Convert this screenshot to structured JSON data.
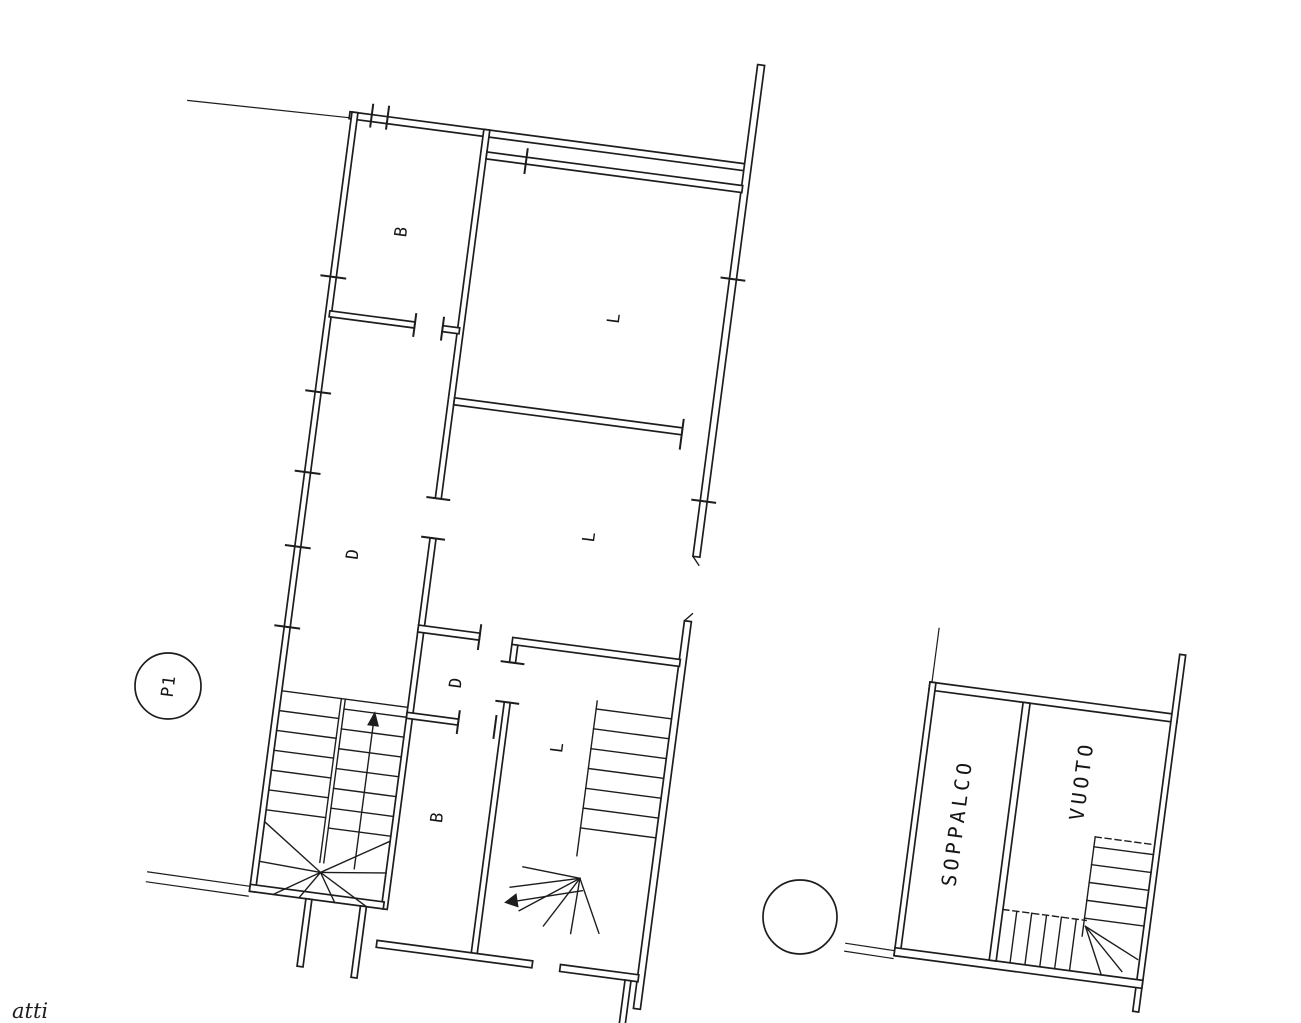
{
  "drawing": {
    "type": "scanned cadastral floor plan",
    "ink_color": "#1d1d1d",
    "paper_color": "#ffffff",
    "floor_badge": {
      "label": "P1"
    },
    "secondary_badge": {
      "label": ""
    },
    "partial_note": "atti",
    "main_plan": {
      "rooms": [
        {
          "id": "bath-top",
          "label": "B"
        },
        {
          "id": "living-top",
          "label": "L"
        },
        {
          "id": "living-middle",
          "label": "L"
        },
        {
          "id": "corridor",
          "label": "D"
        },
        {
          "id": "hall-bottom",
          "label": "D"
        },
        {
          "id": "living-bottom",
          "label": "L"
        },
        {
          "id": "bath-bottom",
          "label": "B"
        }
      ]
    },
    "mezzanine_plan": {
      "rooms": [
        {
          "id": "mezzanine",
          "label": "SOPPALCO"
        },
        {
          "id": "void",
          "label": "VUOTO"
        }
      ]
    }
  }
}
